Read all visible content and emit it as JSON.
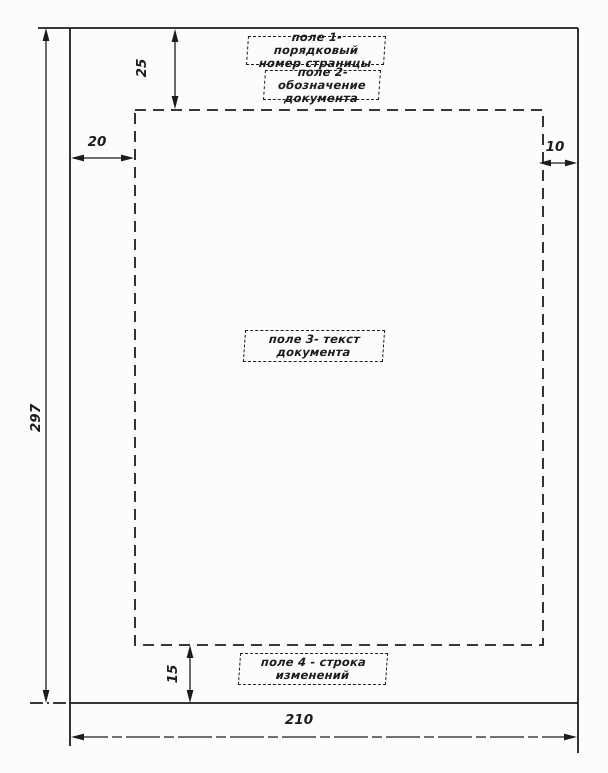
{
  "fields": [
    {
      "line1": "поле 1- порядковый",
      "line2": "номер страницы"
    },
    {
      "line1": "поле 2-обозначение",
      "line2": "документа"
    },
    {
      "line1": "поле 3- текст",
      "line2": "документа"
    },
    {
      "line1": "поле 4 - строка",
      "line2": "изменений"
    }
  ],
  "dimensions": {
    "top_margin": "25",
    "left_margin": "20",
    "right_margin": "10",
    "bottom_margin": "15",
    "sheet_height": "297",
    "sheet_width": "210"
  },
  "colors": {
    "ink": "#1c1c1c",
    "paper": "#fcfcfa"
  }
}
